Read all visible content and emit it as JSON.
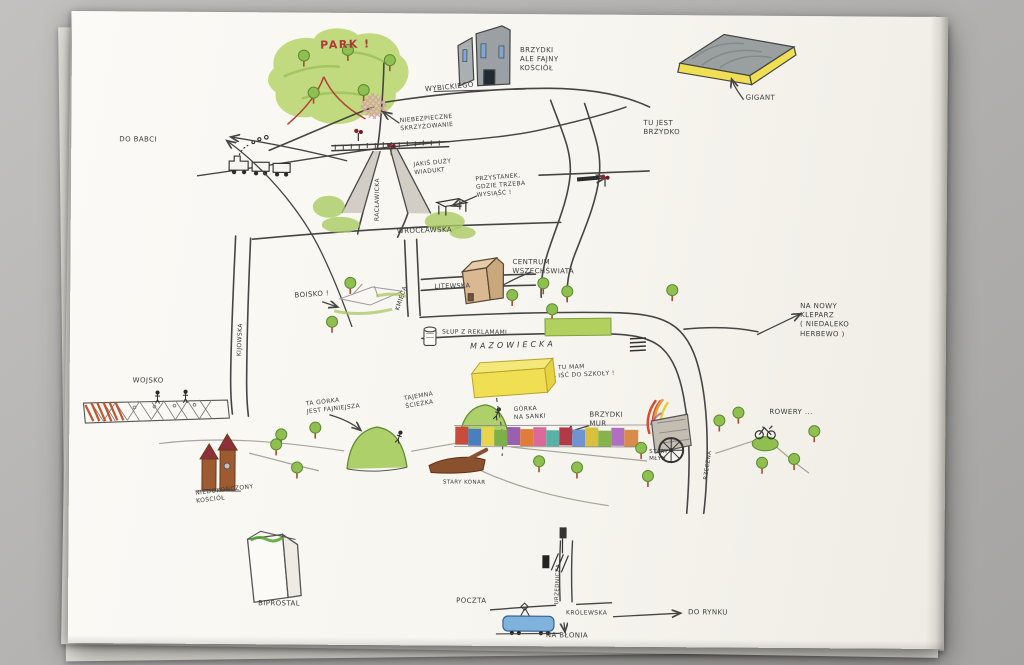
{
  "colors": {
    "background_gray": "#b4b3b2",
    "paper": "#f7f5ef",
    "ink": "#454545",
    "pencil_green": "#a8c861",
    "accent_red": "#b5353f",
    "highlight_yellow": "#f0df52",
    "crossing_pink": "#dd9bb0",
    "tram_blue": "#7fb3de"
  },
  "labels": {
    "park": "PARK !",
    "wybickiego": "WYBICKIEGO",
    "niebezpieczne": "NIEBEZPIECZNE\nSKRZYŻOWANIE",
    "kosciol_brzydki": "BRZYDKI\nALE FAJNY\nKOŚCIÓŁ",
    "gigant": "GIGANT",
    "tu_jest_brzydko": "TU JEST\nBRZYDKO",
    "do_babci": "DO BABCI",
    "wiadukt": "JAKIŚ DUŻY\nWIADUKT",
    "raclawicka": "RACŁAWICKA",
    "przystanek": "PRZYSTANEK,\nGDZIE TRZEBA\nWYSIĄŚĆ !",
    "wroclawska": "WROCŁAWSKA",
    "boisko": "BOISKO !",
    "kmieca": "KMIECA",
    "litewska": "LITEWSKA",
    "centrum_wszechswiata": "CENTRUM\nWSZECHŚWIATA",
    "slup_z_reklamami": "SŁUP Z REKLAMAMI",
    "mazowiecka": "MAZOWIECKA",
    "na_nowy_kleparz": "NA NOWY\nKLEPARZ\n( NIEDALEKO\nHERBEWO )",
    "szkola": "TU MAM\nIŚĆ DO SZKOŁY !",
    "wojsko": "WOJSKO",
    "kijowska": "KIJOWSKA",
    "ta_gorka": "TA GÓRKA\nJEST FAJNIEJSZA",
    "tajemna_sciezka": "TAJEMNA\nŚCIEŻKA",
    "gorka_na_sanki": "GÓRKA\nNA SANKI",
    "brzydki_mur": "BRZYDKI\nMUR",
    "rowery": "ROWERY ...",
    "stary_mlyn": "STARY\nMŁYN",
    "rzeczna": "RZECZNA",
    "stary_konar": "STARY KONAR",
    "niedokonczony_kosciol": "NIEDOKOŃCZONY\nKOŚCIÓŁ",
    "biprostal": "BIPROSTAL",
    "poczta": "POCZTA",
    "urzednicza": "URZĘDNICZA",
    "krolewska": "KRÓLEWSKA",
    "do_rynku": "DO RYNKU",
    "na_blonia": "NA BŁONIA"
  }
}
